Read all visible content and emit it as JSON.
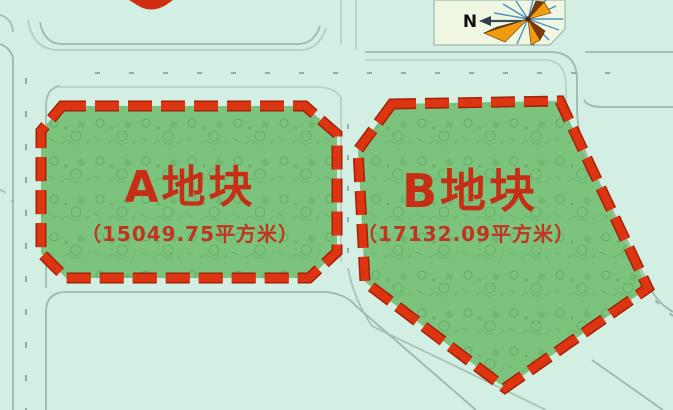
{
  "map": {
    "title": "land-parcel-site-plan",
    "parcels": [
      {
        "id": "A",
        "label": "A地块",
        "area_label": "（15049.75平方米）",
        "area_value": "15049.75",
        "area_unit": "平方米"
      },
      {
        "id": "B",
        "label": "B地块",
        "area_label": "（17132.09平方米）",
        "area_value": "17132.09",
        "area_unit": "平方米"
      }
    ],
    "compass": {
      "label": "N"
    },
    "colors": {
      "background": "#d3efe4",
      "parcel_fill": "#7cc47e",
      "parcel_texture": "#539a5b",
      "border_red_outer": "#a32108",
      "border_red": "#dd3412",
      "label_red": "#c62f16",
      "road_line": "#9cb9ac",
      "road_dash": "#85a497",
      "compass_box": "#eff7e2",
      "compass_ray_blue": "#4d8fc2",
      "compass_orange": "#f09c10",
      "compass_maroon": "#7e3a06",
      "compass_arrow": "#3c4c58",
      "compass_text": "#111111"
    }
  }
}
